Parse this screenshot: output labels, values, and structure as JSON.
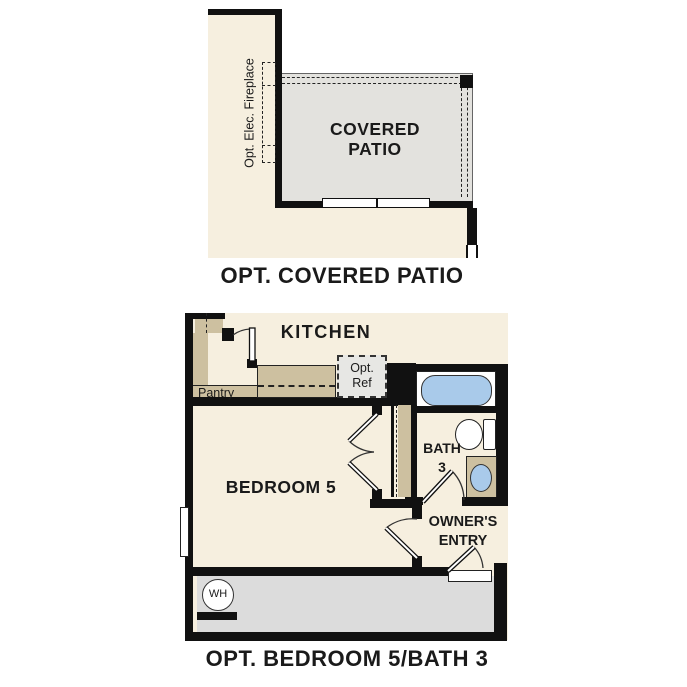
{
  "colors": {
    "cream": "#f6efdf",
    "tan": "#cdc0a0",
    "wall": "#111111",
    "patio": "#e3e2de",
    "garage": "#dcdcdc",
    "blue": "#a9caea",
    "ref": "#e7e7e4",
    "text": "#1a1a1a"
  },
  "patio_plan": {
    "caption": "OPT. COVERED PATIO",
    "room_line1": "COVERED",
    "room_line2": "PATIO",
    "fireplace_label": "Opt. Elec. Fireplace"
  },
  "bedroom_plan": {
    "caption": "OPT. BEDROOM 5/BATH 3",
    "kitchen": "KITCHEN",
    "pantry": "Pantry",
    "ref_line1": "Opt.",
    "ref_line2": "Ref",
    "bedroom": "BEDROOM 5",
    "bath_line1": "BATH",
    "bath_line2": "3",
    "entry_line1": "OWNER'S",
    "entry_line2": "ENTRY",
    "water_heater": "WH"
  }
}
